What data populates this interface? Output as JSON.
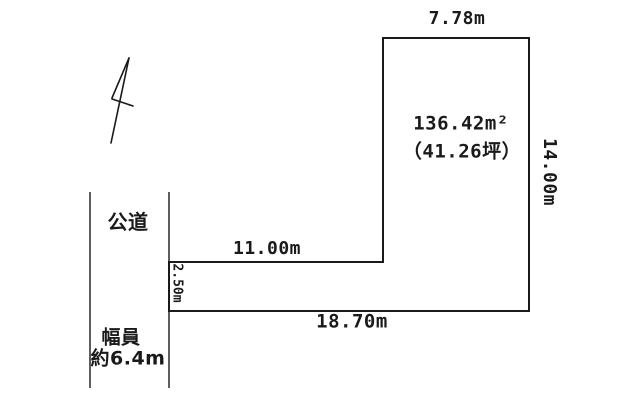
{
  "diagram": {
    "title_hint": "land-plot-survey",
    "lot": {
      "dimensions": {
        "top_width": "7.78m",
        "right_height": "14.00m",
        "bottom_width": "18.70m",
        "inner_width": "11.00m",
        "left_depth": "2.50m"
      },
      "area": {
        "square_meters": "136.42m²",
        "tsubo": "（41.26坪）"
      }
    },
    "road": {
      "label": "公道",
      "width_caption_line1": "幅員",
      "width_caption_line2": "約6.4m"
    },
    "icons": {
      "north_arrow": "north-arrow-icon"
    },
    "colors": {
      "background": "#ffffff",
      "line": "#1a1a1a",
      "text": "#1a1a1a"
    }
  }
}
